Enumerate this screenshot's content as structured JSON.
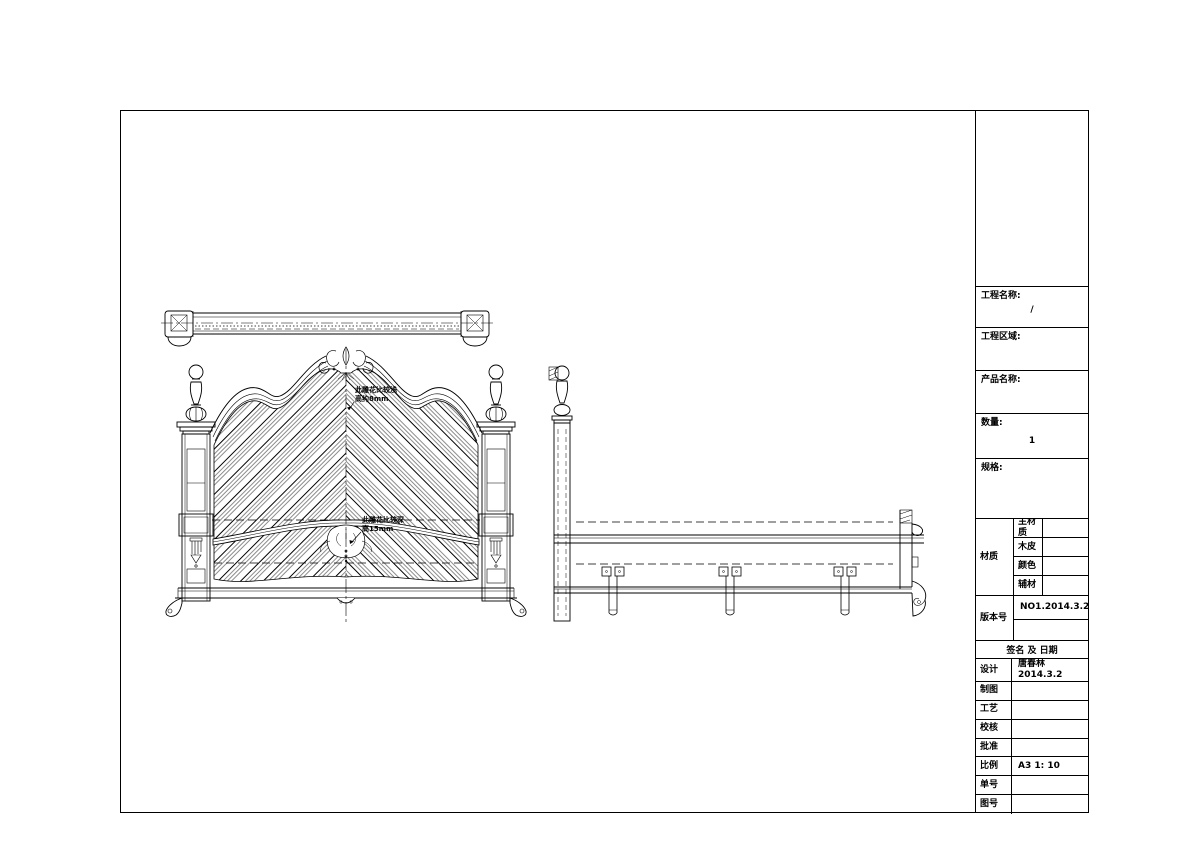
{
  "page": {
    "background": "#ffffff",
    "line_color": "#000000"
  },
  "title_block": {
    "project_name_label": "工程名称:",
    "project_name_value": "/",
    "project_area_label": "工程区域:",
    "product_name_label": "产品名称:",
    "quantity_label": "数量:",
    "quantity_value": "1",
    "spec_label": "规格:",
    "material_label": "材质",
    "material_rows": [
      {
        "label": "主材质",
        "value": ""
      },
      {
        "label": "木皮",
        "value": ""
      },
      {
        "label": "颜色",
        "value": ""
      },
      {
        "label": "辅材",
        "value": ""
      }
    ],
    "version_label": "版本号",
    "version_value": "NO1.2014.3.2",
    "signature_header": "签名 及 日期",
    "sign_rows": [
      {
        "label": "设计",
        "value": "唐春林 2014.3.2"
      },
      {
        "label": "制图",
        "value": ""
      },
      {
        "label": "工艺",
        "value": ""
      },
      {
        "label": "校核",
        "value": ""
      },
      {
        "label": "批准",
        "value": ""
      },
      {
        "label": "比例",
        "value": "A3 1: 10"
      },
      {
        "label": "单号",
        "value": ""
      },
      {
        "label": "图号",
        "value": ""
      }
    ]
  },
  "annotations": {
    "carving_upper": {
      "line1": "此雕花比较浅",
      "line2": "高约8mm"
    },
    "carving_lower": {
      "line1": "此雕花比较深",
      "line2": "高15mm"
    }
  }
}
